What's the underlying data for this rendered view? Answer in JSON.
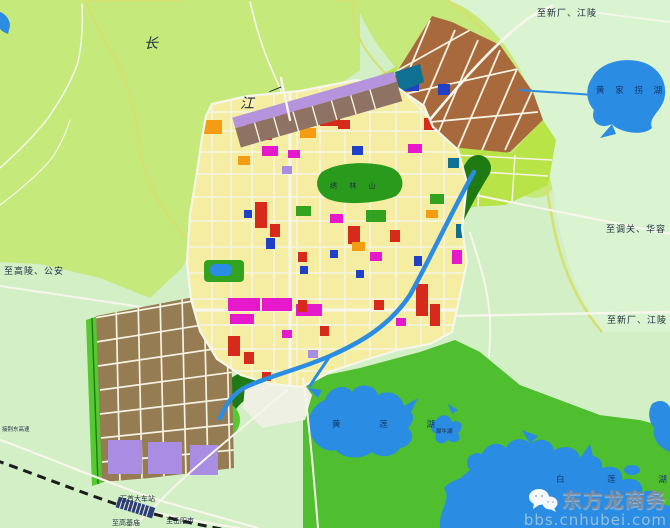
{
  "labels": {
    "river_char_1": "长",
    "river_char_2": "江",
    "river_dash": "—",
    "road_ne_top": "至新厂、江陵",
    "lake_huangjiaguai": "黄 家 拐 湖",
    "road_e_diaoguan": "至调关、华容",
    "road_e_xinchang": "至新厂、江陵",
    "road_w_gaoling": "至高陵、公安",
    "road_sw_expressway": "接荆东高速",
    "hill_xiulin": "绣 林 山",
    "lake_huanglian": "黄 莲 湖",
    "lake_xiniu": "犀牛湖",
    "lake_bailian": "白 莲 湖",
    "station_name": "石首大车站",
    "road_s_gaojimiao": "至高基庙",
    "road_se_yueyang": "至岳阳市"
  },
  "watermark": {
    "brand": "东方龙商务",
    "site": "bbs.cnhubei.com",
    "icon": "wechat-logo"
  },
  "colors": {
    "water": "#2a8ce2",
    "land": "#c5e97b",
    "mint": "#d2efc6",
    "mint2": "#daf4d2",
    "lime": "#b9e448",
    "corridor": "#55c832",
    "seGreen": "#4fbe2f",
    "hill": "#2a9a1d",
    "parkGreen": "#33a21f",
    "cityYellow": "#f4eda2",
    "red": "#d62b1a",
    "magenta": "#e518cb",
    "orange": "#f59c15",
    "brown": "#a86a3c",
    "port": "#8e7263",
    "lavender": "#b693dd",
    "tan": "#967c52",
    "purple": "#a98de2",
    "teal": "#107094",
    "navy": "#2140c8",
    "road": "#f7f6ea",
    "roadY": "#ece8b4",
    "grid": "#f6f3e4",
    "levee": "#d5e06e",
    "whitePatch": "#eef0e4",
    "rail": "#1c1c1c",
    "stationFill": "#2b3e78",
    "label": "#1f2b3e",
    "wmGrey": "rgba(128,132,140,0.82)",
    "wmBlue": "rgba(155,196,218,0.92)"
  }
}
